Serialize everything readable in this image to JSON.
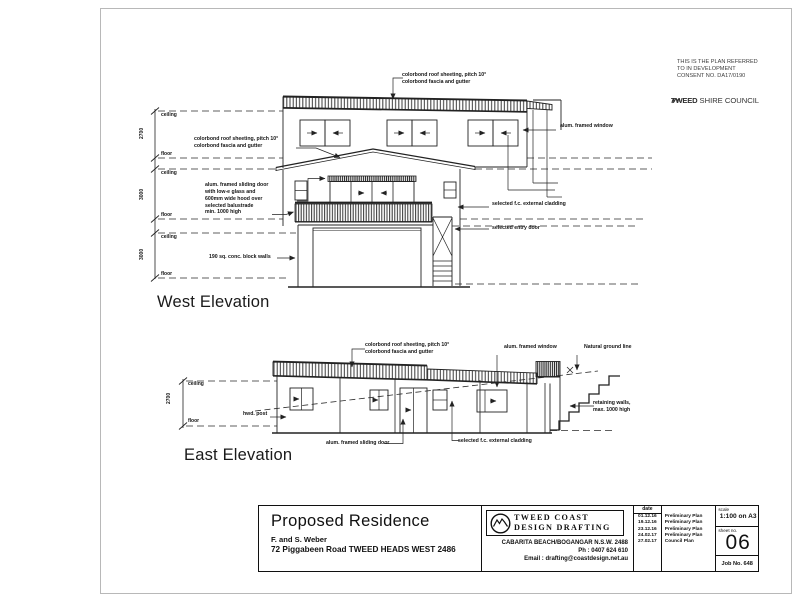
{
  "stamp": {
    "text": "THIS IS THE PLAN REFERRED\nTO IN DEVELOPMENT\nCONSENT NO. DA17/0190",
    "council_bold": "TWEED",
    "council_rest": " SHIRE COUNCIL"
  },
  "west": {
    "title": "West Elevation",
    "notes": {
      "roof_top": "colorbond roof sheeting, pitch 10°\ncolorbond fascia and gutter",
      "roof_mid": "colorbond roof sheeting, pitch 10°\ncolorbond fascia and gutter",
      "sliding_door": "alum. framed sliding door\nwith low-e glass and\n600mm wide hood over\nselected balustrade\nmin. 1000 high",
      "window": "alum. framed window",
      "cladding": "selected f.c. external cladding",
      "entry_door": "selected entry door",
      "block_walls": "190 sq. conc. block walls"
    },
    "dims": {
      "ceiling": "ceiling",
      "floor": "floor",
      "upper": "2700",
      "middle": "3000",
      "lower": "3000"
    }
  },
  "east": {
    "title": "East Elevation",
    "notes": {
      "roof": "colorbond roof sheeting, pitch 10°\ncolorbond fascia and gutter",
      "window": "alum. framed window",
      "ground": "Natural ground line",
      "retaining": "retaining walls,\nmax. 1000 high",
      "post": "hwd. post",
      "sliding_door": "alum. framed sliding door",
      "cladding": "selected f.c. external cladding"
    },
    "dims": {
      "ceiling": "ceiling",
      "floor": "floor",
      "height": "2700"
    }
  },
  "titleblock": {
    "project": "Proposed Residence",
    "client": "F. and S. Weber",
    "address": "72 Piggabeen Road TWEED HEADS WEST 2486",
    "firm_line1": "TWEED  COAST",
    "firm_line2": "DESIGN  DRAFTING",
    "firm_address": "CABARITA BEACH/BOGANGAR N.S.W. 2488",
    "firm_phone": "Ph : 0407 624 610",
    "firm_email": "Email : drafting@coastdesign.net.au",
    "revisions_header": "date",
    "revisions": [
      {
        "date": "01.12.16",
        "desc": "Preliminary Plan"
      },
      {
        "date": "19.12.16",
        "desc": "Preliminary Plan"
      },
      {
        "date": "23.12.16",
        "desc": "Preliminary Plan"
      },
      {
        "date": "24.02.17",
        "desc": "Preliminary Plan"
      },
      {
        "date": "27.02.17",
        "desc": "Council Plan"
      }
    ],
    "scale_label": "scale",
    "scale": "1:100 on A3",
    "sheet_label": "sheet no.",
    "sheet": "06",
    "job": "Job No. 648"
  }
}
